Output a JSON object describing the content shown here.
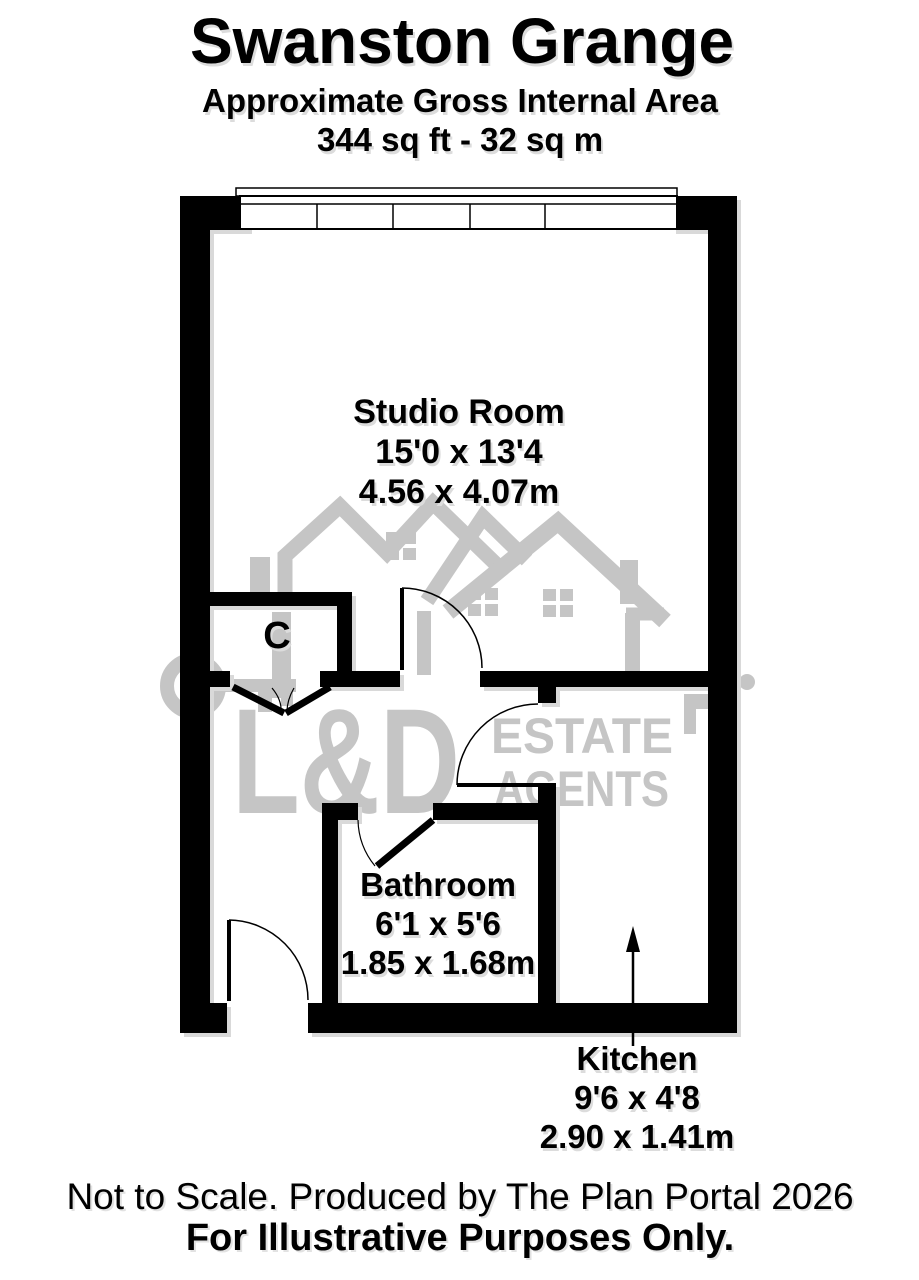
{
  "header": {
    "title": "Swanston Grange",
    "subtitle": "Approximate Gross Internal Area",
    "area": "344 sq ft - 32 sq m"
  },
  "rooms": {
    "studio": {
      "name": "Studio Room",
      "imperial": "15'0 x 13'4",
      "metric": "4.56 x 4.07m"
    },
    "closet": {
      "label": "C"
    },
    "bathroom": {
      "name": "Bathroom",
      "imperial": "6'1 x 5'6",
      "metric": "1.85 x 1.68m"
    },
    "kitchen": {
      "name": "Kitchen",
      "imperial": "9'6 x 4'8",
      "metric": "2.90 x 1.41m"
    }
  },
  "watermark": {
    "brand": "L&D",
    "line1": "ESTATE",
    "line2": "AGENTS",
    "color": "#c5c5c5"
  },
  "footer": {
    "line1": "Not to Scale. Produced by The Plan Portal 2026",
    "line2": "For Illustrative Purposes Only."
  },
  "colors": {
    "wall": "#000000",
    "shadow": "#d9d9d9",
    "watermark": "#c5c5c5"
  }
}
